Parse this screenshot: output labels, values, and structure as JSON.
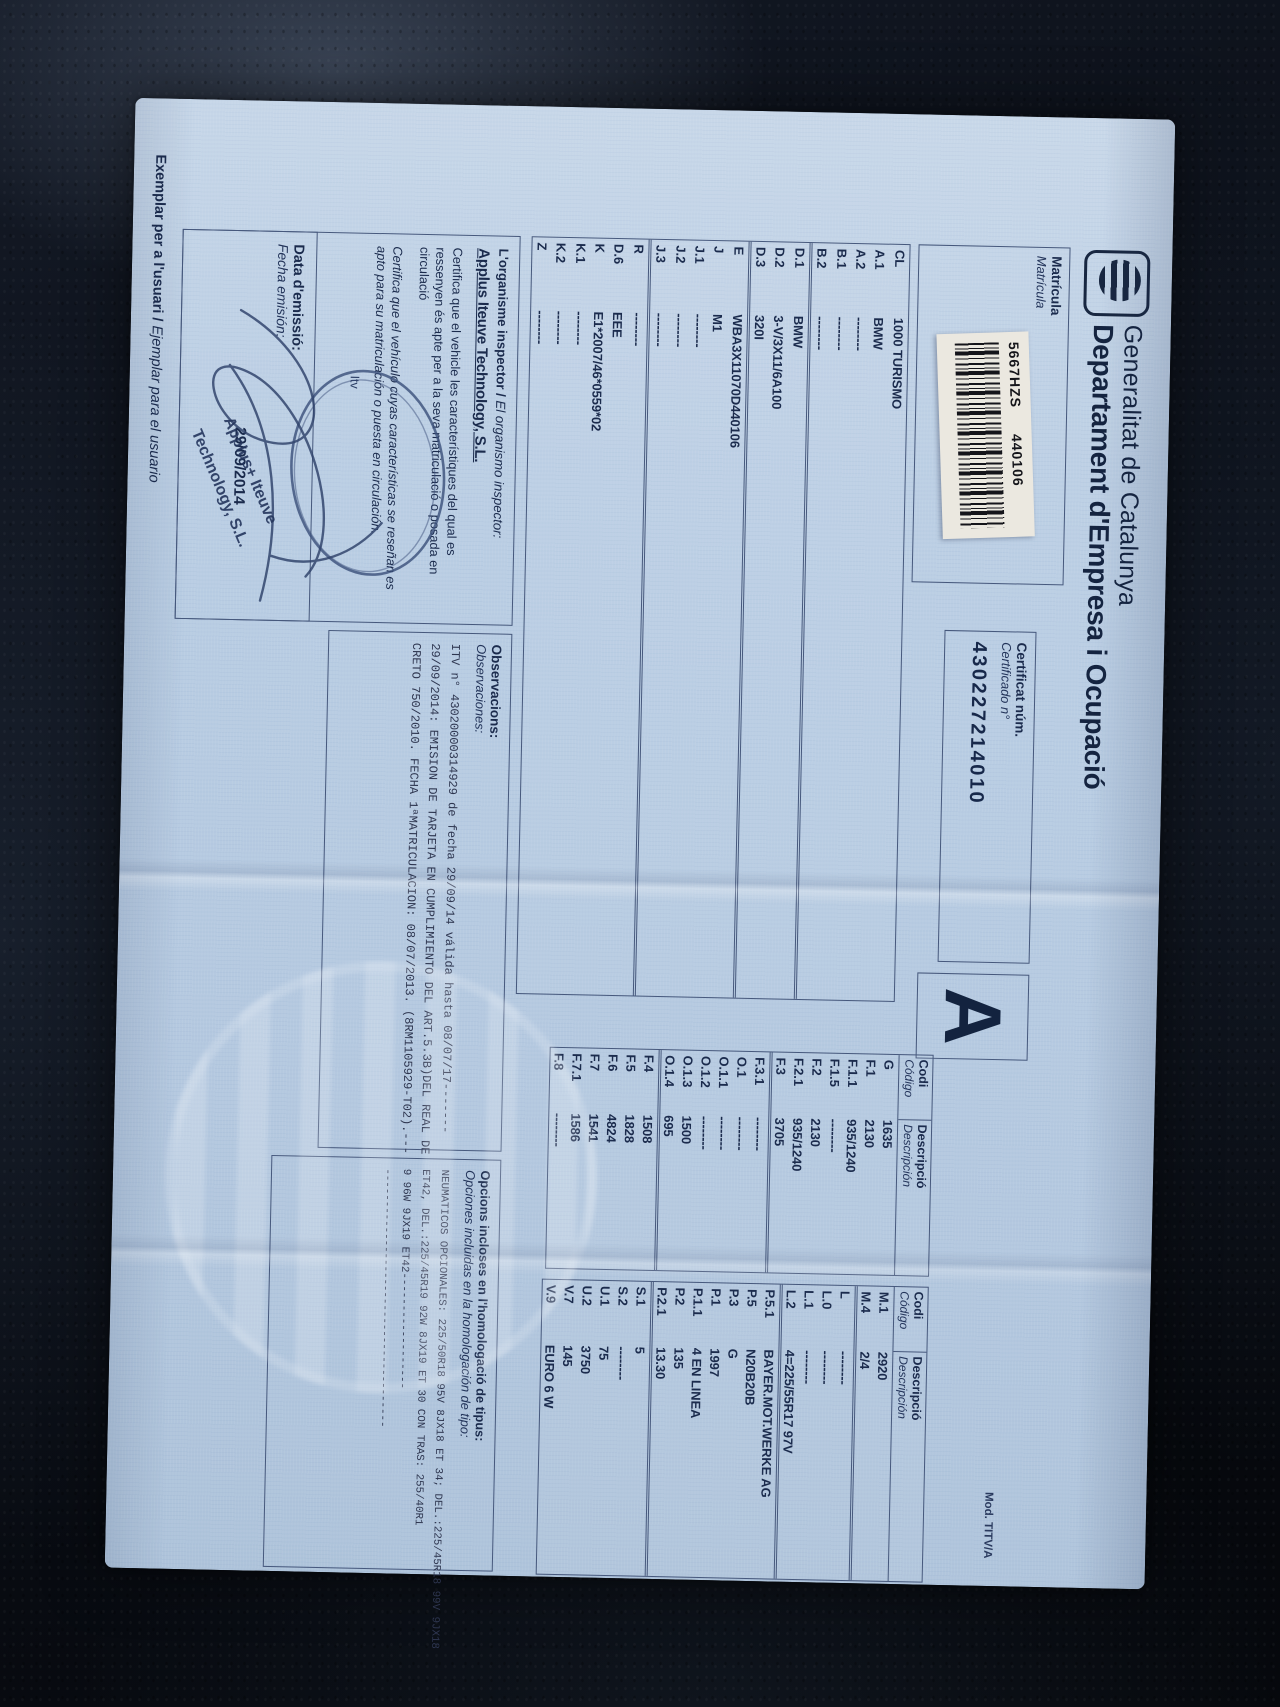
{
  "header": {
    "org": "Generalitat de Catalunya",
    "dept": "Departament d'Empresa i Ocupació"
  },
  "matricula": {
    "label_ca": "Matrícula",
    "label_es": "Matrícula",
    "plate": "5667HZS",
    "plate_code": "440106"
  },
  "certificat": {
    "label_ca": "Certificat núm.",
    "label_es": "Certificado n°",
    "number": "430227214010"
  },
  "doc_class": "A",
  "mod_ref": "Mod. TITV/A",
  "table_headers": {
    "codi_ca": "Codi",
    "codi_es": "Código",
    "desc_ca": "Descripció",
    "desc_es": "Descripción"
  },
  "tables": {
    "left": [
      [
        "CL",
        "1000 TURISMO"
      ],
      [
        "A.1",
        "BMW"
      ],
      [
        "A.2",
        "--------"
      ],
      [
        "B.1",
        "--------"
      ],
      [
        "B.2",
        "--------"
      ],
      [
        "D.1",
        "BMW"
      ],
      [
        "D.2",
        "3-V/3X11/6A100"
      ],
      [
        "D.3",
        "320I"
      ],
      [
        "E",
        "WBA3X11070D440106"
      ],
      [
        "J",
        "M1"
      ],
      [
        "J.1",
        "--------"
      ],
      [
        "J.2",
        "--------"
      ],
      [
        "J.3",
        "--------"
      ],
      [
        "R",
        "--------"
      ],
      [
        "D.6",
        "EEE"
      ],
      [
        "K",
        "E1*2007/46*0559*02"
      ],
      [
        "K.1",
        "--------"
      ],
      [
        "K.2",
        "--------"
      ],
      [
        "Z",
        "--------"
      ]
    ],
    "middle": [
      [
        "G",
        "1635"
      ],
      [
        "F.1",
        "2130"
      ],
      [
        "F.1.1",
        "935/1240"
      ],
      [
        "F.1.5",
        "--------"
      ],
      [
        "F.2",
        "2130"
      ],
      [
        "F.2.1",
        "935/1240"
      ],
      [
        "F.3",
        "3705"
      ],
      [
        "F.3.1",
        "--------"
      ],
      [
        "O.1",
        "--------"
      ],
      [
        "O.1.1",
        "--------"
      ],
      [
        "O.1.2",
        "--------"
      ],
      [
        "O.1.3",
        "1500"
      ],
      [
        "O.1.4",
        "695"
      ],
      [
        "F.4",
        "1508"
      ],
      [
        "F.5",
        "1828"
      ],
      [
        "F.6",
        "4824"
      ],
      [
        "F.7",
        "1541"
      ],
      [
        "F.7.1",
        "1586"
      ],
      [
        "F.8",
        "--------"
      ]
    ],
    "right": [
      [
        "M.1",
        "2920"
      ],
      [
        "M.4",
        "2/4"
      ],
      [
        "L",
        "--------"
      ],
      [
        "L.0",
        "--------"
      ],
      [
        "L.1",
        "--------"
      ],
      [
        "L.2",
        "4=225/55R17 97V"
      ],
      [
        "P.5.1",
        "BAYER.MOT.WERKE AG"
      ],
      [
        "P.5",
        "N20B20B"
      ],
      [
        "P.3",
        "G"
      ],
      [
        "P.1",
        "1997"
      ],
      [
        "P.1.1",
        "4 EN LINEA"
      ],
      [
        "P.2",
        "135"
      ],
      [
        "P.2.1",
        "13.30"
      ],
      [
        "S.1",
        "5"
      ],
      [
        "S.2",
        "--------"
      ],
      [
        "U.1",
        "75"
      ],
      [
        "U.2",
        "3750"
      ],
      [
        "V.7",
        "145"
      ],
      [
        "V.9",
        "EURO 6 W"
      ]
    ]
  },
  "inspector": {
    "label_ca": "L'organisme inspector /",
    "label_es": "El organismo inspector:",
    "company": "Applus Iteuve Technology, S.L.",
    "cert_ca": "Certifica que el vehicle les característiques del qual es ressenyen és apte per a la seva matriculació o posada en circulació",
    "cert_es": "Certifica que el vehículo cuyas características se reseñan es apto para su matriculación o puesta en circulación.",
    "stamp_itv": "Itv",
    "stamp_line1": "Applus+ Iteuve",
    "stamp_line2": "Technology, S.L."
  },
  "observations": {
    "label_ca": "Observacions:",
    "label_es": "Observaciones:",
    "lines": [
      "ITV n° 43020000314929 de fecha 29/09/14 válida hasta 08/07/17-------",
      "29/09/2014: EMISION DE TARJETA EN CUMPLIMIENTO DEL ART.5.3B)DEL REAL DE",
      "CRETO 750/2010. FECHA 1ªMATRICULACION: 08/07/2013. (8RM1105929-T02).---"
    ]
  },
  "options": {
    "label_ca": "Opcions incloses en l'homologació de tipus:",
    "label_es": "Opciones incluidas en la homologación de tipo:",
    "lines": [
      "NEUMATICOS OPCIONALES: 225/50R18 95V 8JX18 ET 34; DEL.:225/45R18 99V 9JX18",
      "ET42, DEL.:225/45R19 92W 8JX19 ET 30 CON TRAS: 255/40R1",
      "9 96W 9JX19 ET42------------------",
      "----------------------------------------"
    ]
  },
  "emission": {
    "label_ca": "Data d'emissió:",
    "label_es": "Fecha emisión:",
    "date": "29/09/2014"
  },
  "footer": {
    "ca": "Exemplar per a l'usuari /",
    "es": " Ejemplar para el usuario"
  }
}
